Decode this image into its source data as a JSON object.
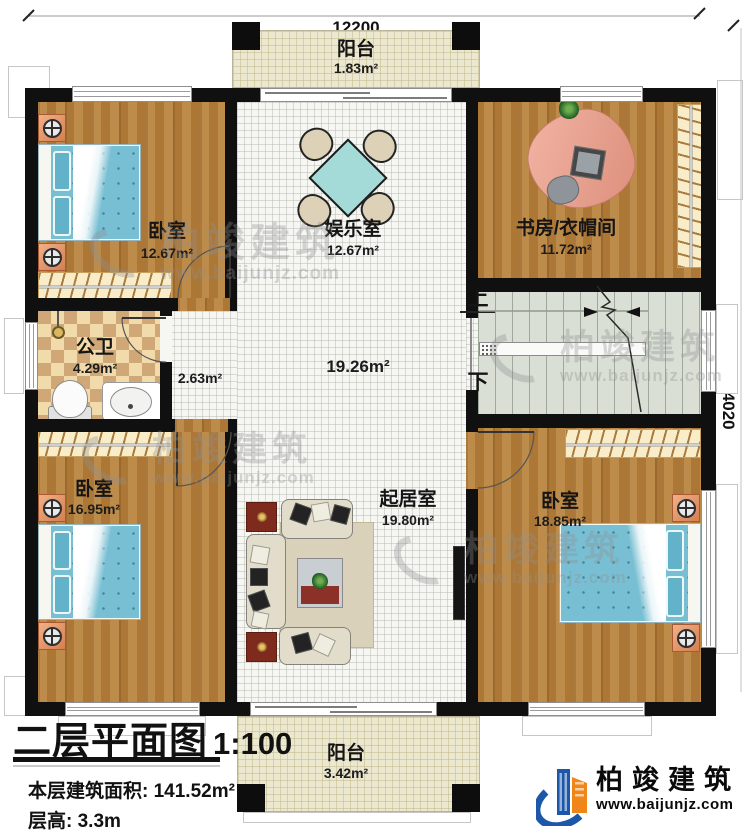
{
  "dimensions": {
    "top": "12200",
    "right": "14020"
  },
  "rooms": {
    "balcony_top": {
      "name": "阳台",
      "area": "1.83m²"
    },
    "bedroom_tl": {
      "name": "卧室",
      "area": "12.67m²"
    },
    "entertainment": {
      "name": "娱乐室",
      "area": "12.67m²"
    },
    "study": {
      "name": "书房/衣帽间",
      "area": "11.72m²"
    },
    "bathroom": {
      "name": "公卫",
      "area": "4.29m²"
    },
    "corridor": {
      "area": "2.63m²"
    },
    "hall": {
      "area": "19.26m²"
    },
    "living": {
      "name": "起居室",
      "area": "19.80m²"
    },
    "bedroom_bl": {
      "name": "卧室",
      "area": "16.95m²"
    },
    "bedroom_br": {
      "name": "卧室",
      "area": "18.85m²"
    },
    "balcony_bottom": {
      "name": "阳台",
      "area": "3.42m²"
    }
  },
  "stairs": {
    "up": "上",
    "down": "下"
  },
  "title_block": {
    "title": "二层平面图",
    "scale": "1:100",
    "area_label": "本层建筑面积:",
    "area_value": "141.52m²",
    "height_label": "层高:",
    "height_value": "3.3m"
  },
  "brand": {
    "name": "柏竣建筑",
    "url": "www.baijunjz.com"
  },
  "watermark": {
    "name": "柏竣建筑",
    "url": "www.baijunjz.com"
  },
  "colors": {
    "wall": "#101010",
    "wood": "#b27d3b",
    "hall_floor": "#f6f6f3",
    "balcony": "#ece8d0",
    "bath_tile": "#d0a878",
    "stairs": "#d9dfd5",
    "bed_blue": "#79bfd3",
    "nightstand_orange": "#d67e4f",
    "brand_blue": "#1c57aa",
    "brand_orange": "#f08519",
    "watermark_gray": "#8f8f92"
  }
}
